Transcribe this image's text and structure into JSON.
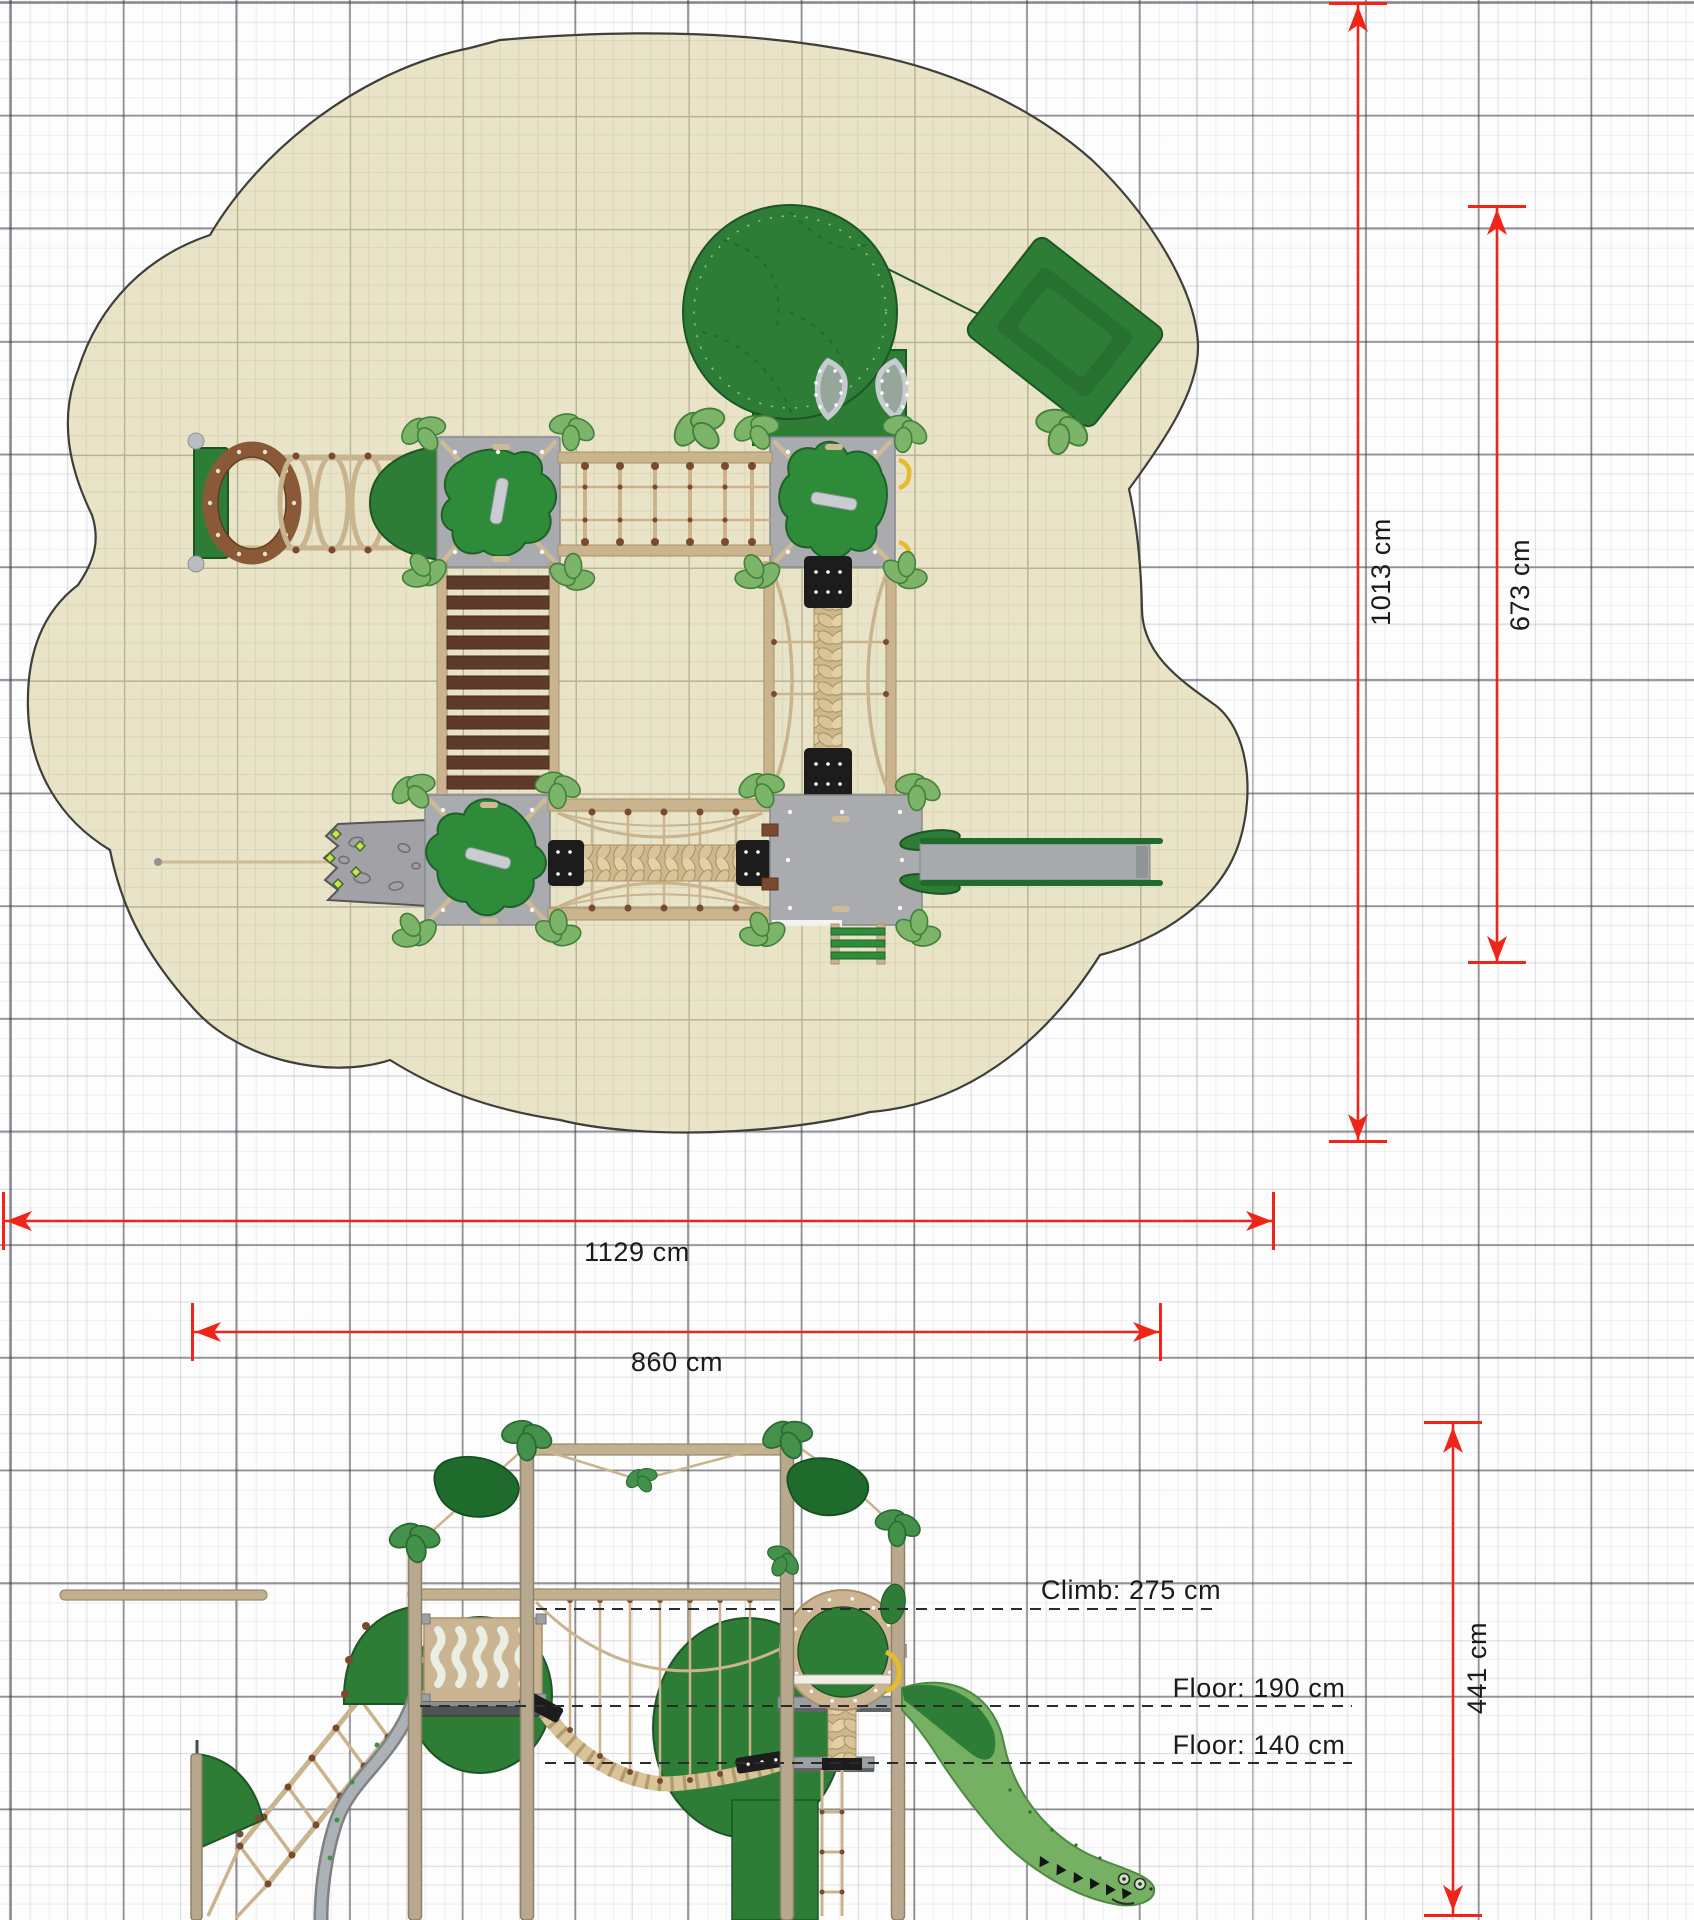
{
  "dims": {
    "plan_outer_vertical": "1013 cm",
    "plan_inner_vertical": "673 cm",
    "plan_outer_horizontal": "1129 cm",
    "plan_inner_horizontal": "860 cm",
    "elevation_overall_height": "441 cm"
  },
  "annotations": {
    "climb": "Climb: 275 cm",
    "floor_upper": "Floor: 190 cm",
    "floor_lower": "Floor: 140 cm"
  },
  "colors": {
    "dimension_red": "#f02418",
    "annotation_text": "#1a1a1a",
    "safety_zone_beige": "#e9e4c8",
    "equipment_green": "#2e7d36",
    "panel_green": "#2e8b3a",
    "leaf_green": "#7cb56a",
    "crocodile_green": "#76b063",
    "platform_gray": "#a9abaf",
    "slide_gray": "#a7abae",
    "wood_tan": "#c9b48d",
    "plank_brown": "#5e3b28",
    "knot_brown": "#7a4a30",
    "pad_black": "#1c1c1c",
    "grid_major": "#8f8f94",
    "grid_minor": "#e6e6ee"
  }
}
